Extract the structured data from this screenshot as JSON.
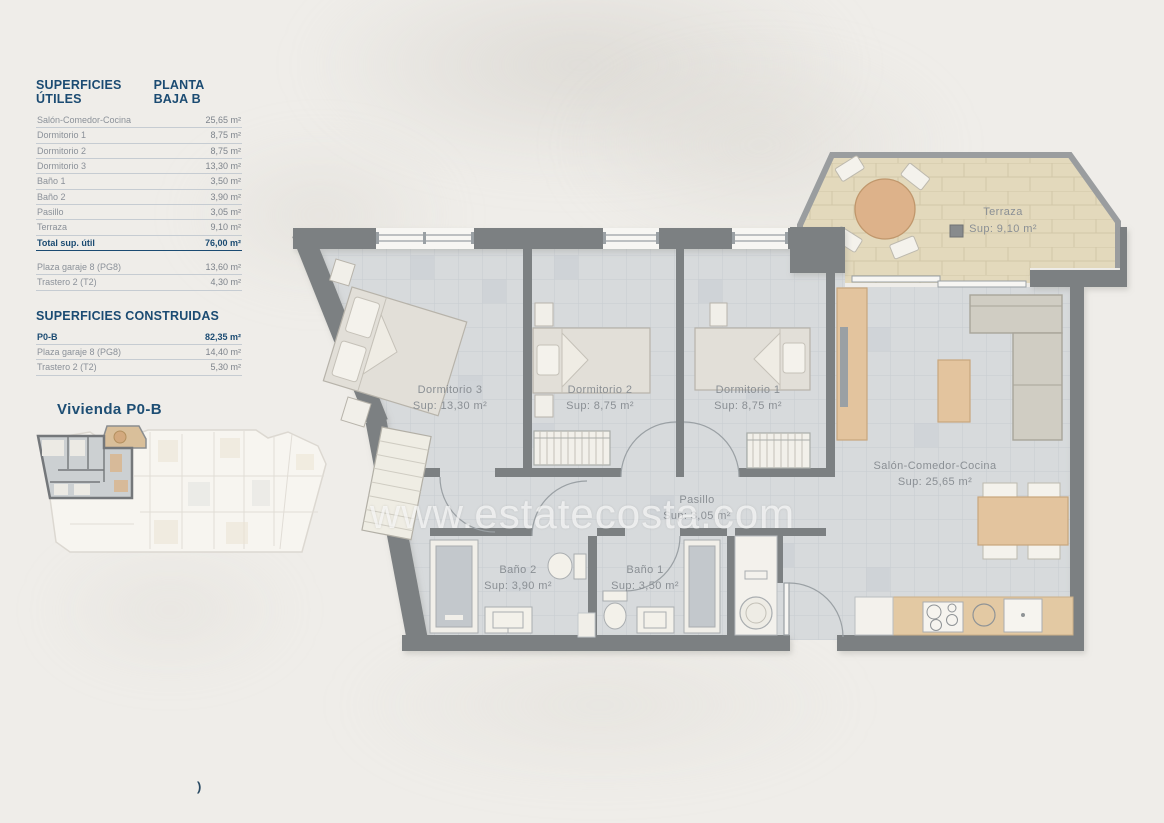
{
  "page": {
    "background": "#efede9",
    "artifact": ")"
  },
  "colors": {
    "navy": "#1b4b72",
    "row_gray": "#8b9199",
    "wall_gray": "#7c8082",
    "floor_gray": "#d6d9db",
    "terrace_tan": "#e3d9bc",
    "wood_tan": "#e3c49e",
    "label_gray": "#8a8f94",
    "watermark_white": "#ffffff"
  },
  "tables": {
    "utiles": {
      "title": "SUPERFICIES ÚTILES",
      "subtitle": "PLANTA BAJA B",
      "rows": [
        {
          "label": "Salón-Comedor-Cocina",
          "value": "25,65 m²"
        },
        {
          "label": "Dormitorio 1",
          "value": "8,75 m²"
        },
        {
          "label": "Dormitorio 2",
          "value": "8,75 m²"
        },
        {
          "label": "Dormitorio 3",
          "value": "13,30 m²"
        },
        {
          "label": "Baño 1",
          "value": "3,50 m²"
        },
        {
          "label": "Baño 2",
          "value": "3,90 m²"
        },
        {
          "label": "Pasillo",
          "value": "3,05 m²"
        },
        {
          "label": "Terraza",
          "value": "9,10 m²"
        }
      ],
      "total": {
        "label": "Total sup. útil",
        "value": "76,00 m²"
      },
      "annex_rows": [
        {
          "label": "Plaza garaje 8 (PG8)",
          "value": "13,60 m²"
        },
        {
          "label": "Trastero 2 (T2)",
          "value": "4,30 m²"
        }
      ]
    },
    "construidas": {
      "title": "SUPERFICIES CONSTRUIDAS",
      "rows": [
        {
          "label": "P0-B",
          "value": "82,35 m²"
        },
        {
          "label": "Plaza garaje 8 (PG8)",
          "value": "14,40 m²"
        },
        {
          "label": "Trastero 2 (T2)",
          "value": "5,30 m²"
        }
      ]
    }
  },
  "site_plan": {
    "label": "Vivienda P0-B"
  },
  "floor_plan": {
    "watermark": "www.estatecosta.com",
    "rooms": [
      {
        "name": "Dormitorio 3",
        "area": "Sup: 13,30 m²"
      },
      {
        "name": "Dormitorio 2",
        "area": "Sup: 8,75 m²"
      },
      {
        "name": "Dormitorio 1",
        "area": "Sup: 8,75 m²"
      },
      {
        "name": "Salón-Comedor-Cocina",
        "area": "Sup: 25,65 m²"
      },
      {
        "name": "Pasillo",
        "area": "Sup: 3,05 m²"
      },
      {
        "name": "Baño 1",
        "area": "Sup: 3,50 m²"
      },
      {
        "name": "Baño 2",
        "area": "Sup: 3,90 m²"
      },
      {
        "name": "Terraza",
        "area": "Sup: 9,10 m²"
      }
    ]
  }
}
